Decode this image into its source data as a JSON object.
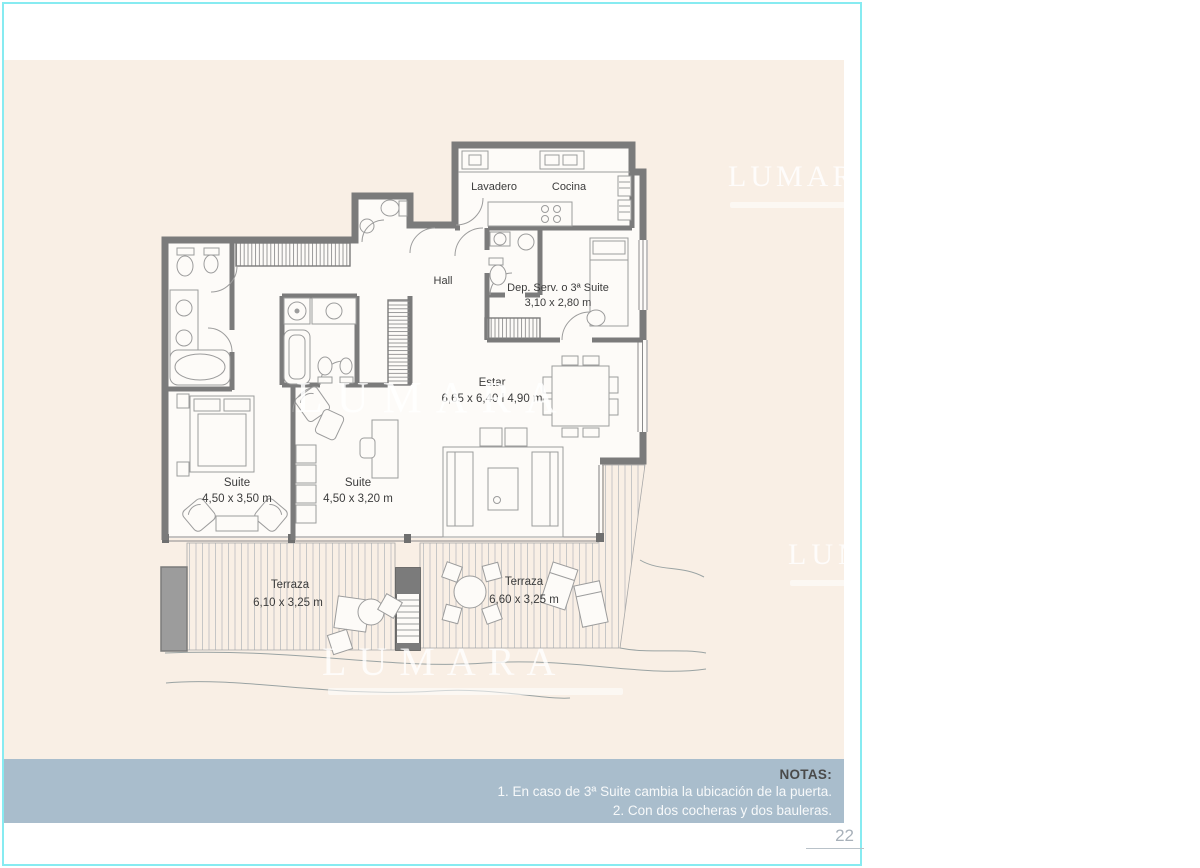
{
  "page": {
    "number": "22"
  },
  "watermark": {
    "text": "LUMARA"
  },
  "plan": {
    "rooms": {
      "lavadero": {
        "label": "Lavadero"
      },
      "cocina": {
        "label": "Cocina"
      },
      "hall": {
        "label": "Hall"
      },
      "dep_serv": {
        "label": "Dep. Serv. o 3ª Suite",
        "dims": "3,10 x 2,80 m"
      },
      "estar": {
        "label": "Estar",
        "dims": "6,65 x 6,40 l 4,90 m"
      },
      "suite1": {
        "label": "Suite",
        "dims": "4,50 x 3,50 m"
      },
      "suite2": {
        "label": "Suite",
        "dims": "4,50 x 3,20 m"
      },
      "terraza1": {
        "label": "Terraza",
        "dims": "6,10 x 3,25 m"
      },
      "terraza2": {
        "label": "Terraza",
        "dims": "6,60 x 3,25 m"
      }
    }
  },
  "notes": {
    "title": "NOTAS:",
    "items": [
      "1. En caso de 3ª Suite cambia la ubicación de la puerta.",
      "2. Con dos cocheras y dos bauleras."
    ]
  },
  "colors": {
    "page_background": "#f9efe5",
    "frame_border": "#87ebf1",
    "notes_band": "#a9bdcc",
    "walls": "#7b7b7b",
    "watermark": "#ffffff"
  }
}
